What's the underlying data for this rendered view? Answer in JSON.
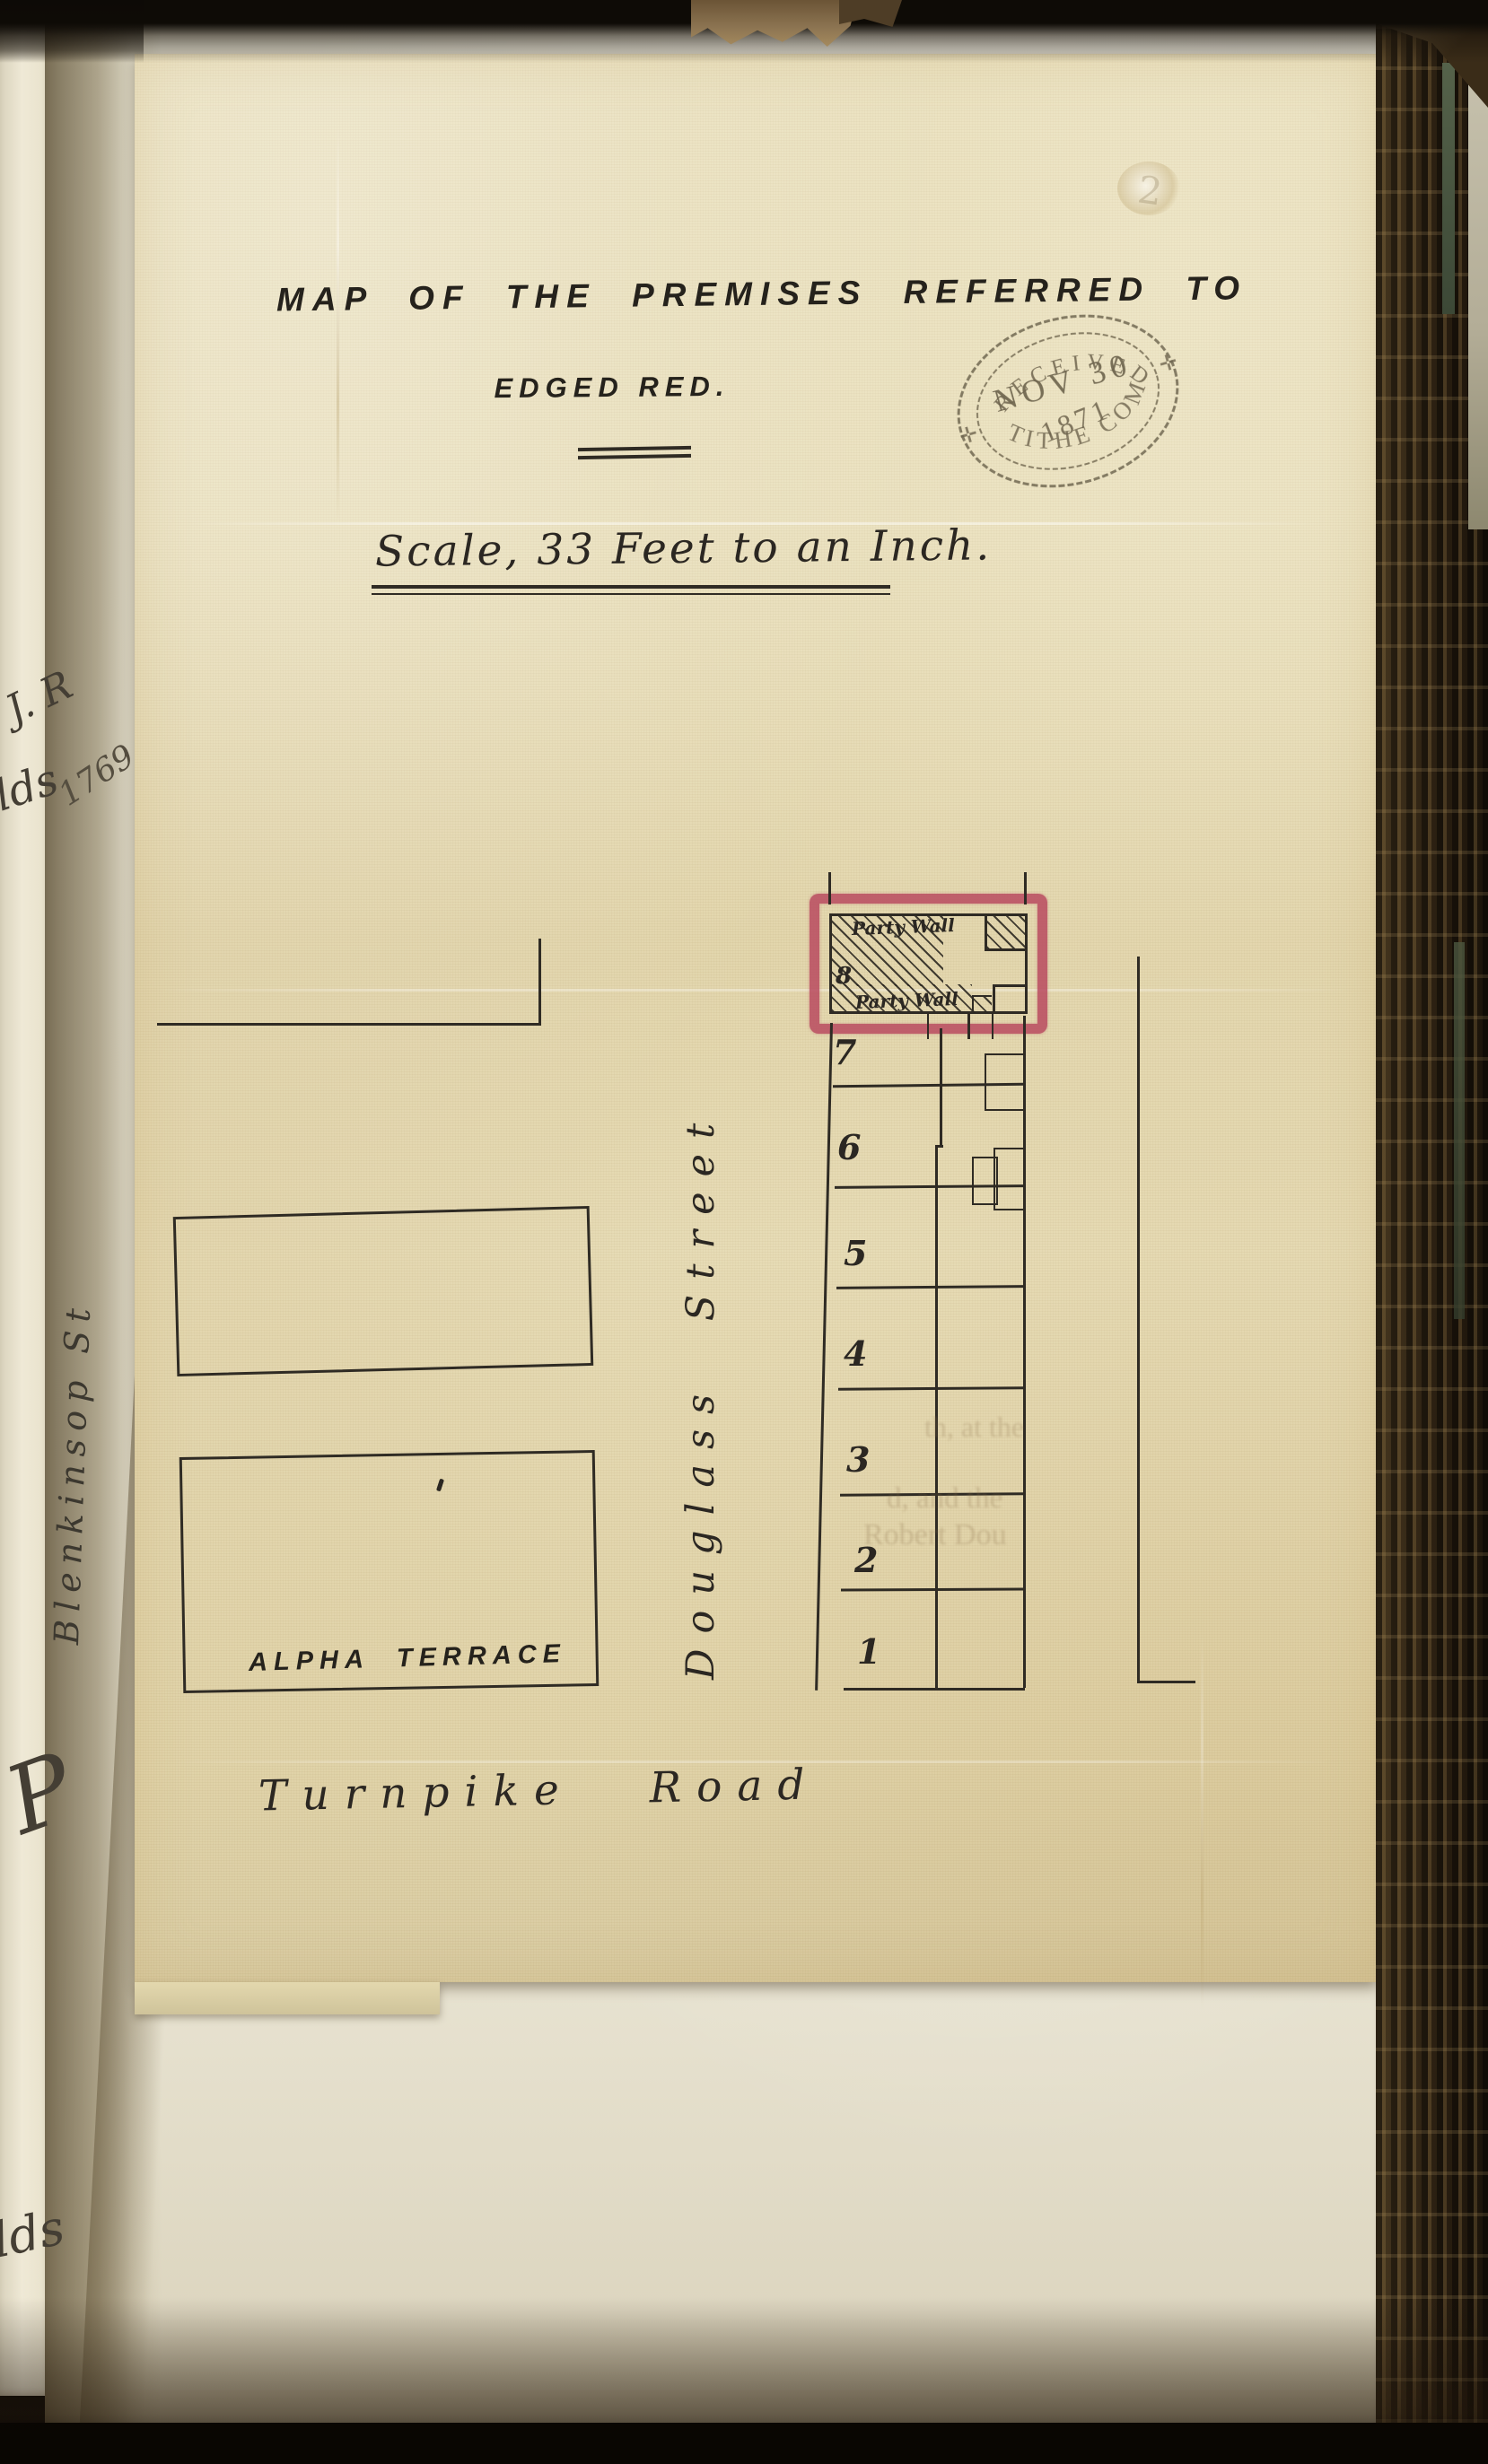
{
  "document": {
    "title_line": "MAP OF THE PREMISES REFERRED TO",
    "subtitle_line": "EDGED RED.",
    "scale_note": "Scale, 33 Feet to an Inch.",
    "faint_numeral": "2"
  },
  "stamp": {
    "arc_top": "RECEIVED",
    "date_month_day": "NOV 30",
    "date_year": "1871",
    "arc_bottom": "TITHE COM",
    "left_mark": "✛",
    "right_mark": "✛"
  },
  "map": {
    "street_left": "Blenkinsop St",
    "street_center": "Douglass Street",
    "road_bottom": "Turnpike Road",
    "terrace_label": "ALPHA TERRACE",
    "red_plot": {
      "number": "8",
      "party_wall_top": "Party Wall",
      "party_wall_bottom": "Party Wall",
      "edge_color": "#b84a5f"
    },
    "plot_numbers": [
      "7",
      "6",
      "5",
      "4",
      "3",
      "2",
      "1"
    ]
  },
  "marginalia": {
    "fragment_jr": "J. R",
    "fragment_lds_upper": "lds",
    "year": "1769",
    "fragment_p": "P",
    "fragment_lds_lower": "lds"
  },
  "bleed_through": {
    "line1": "th, at the",
    "line2": "d, and the",
    "line3": "Robert Dou"
  }
}
